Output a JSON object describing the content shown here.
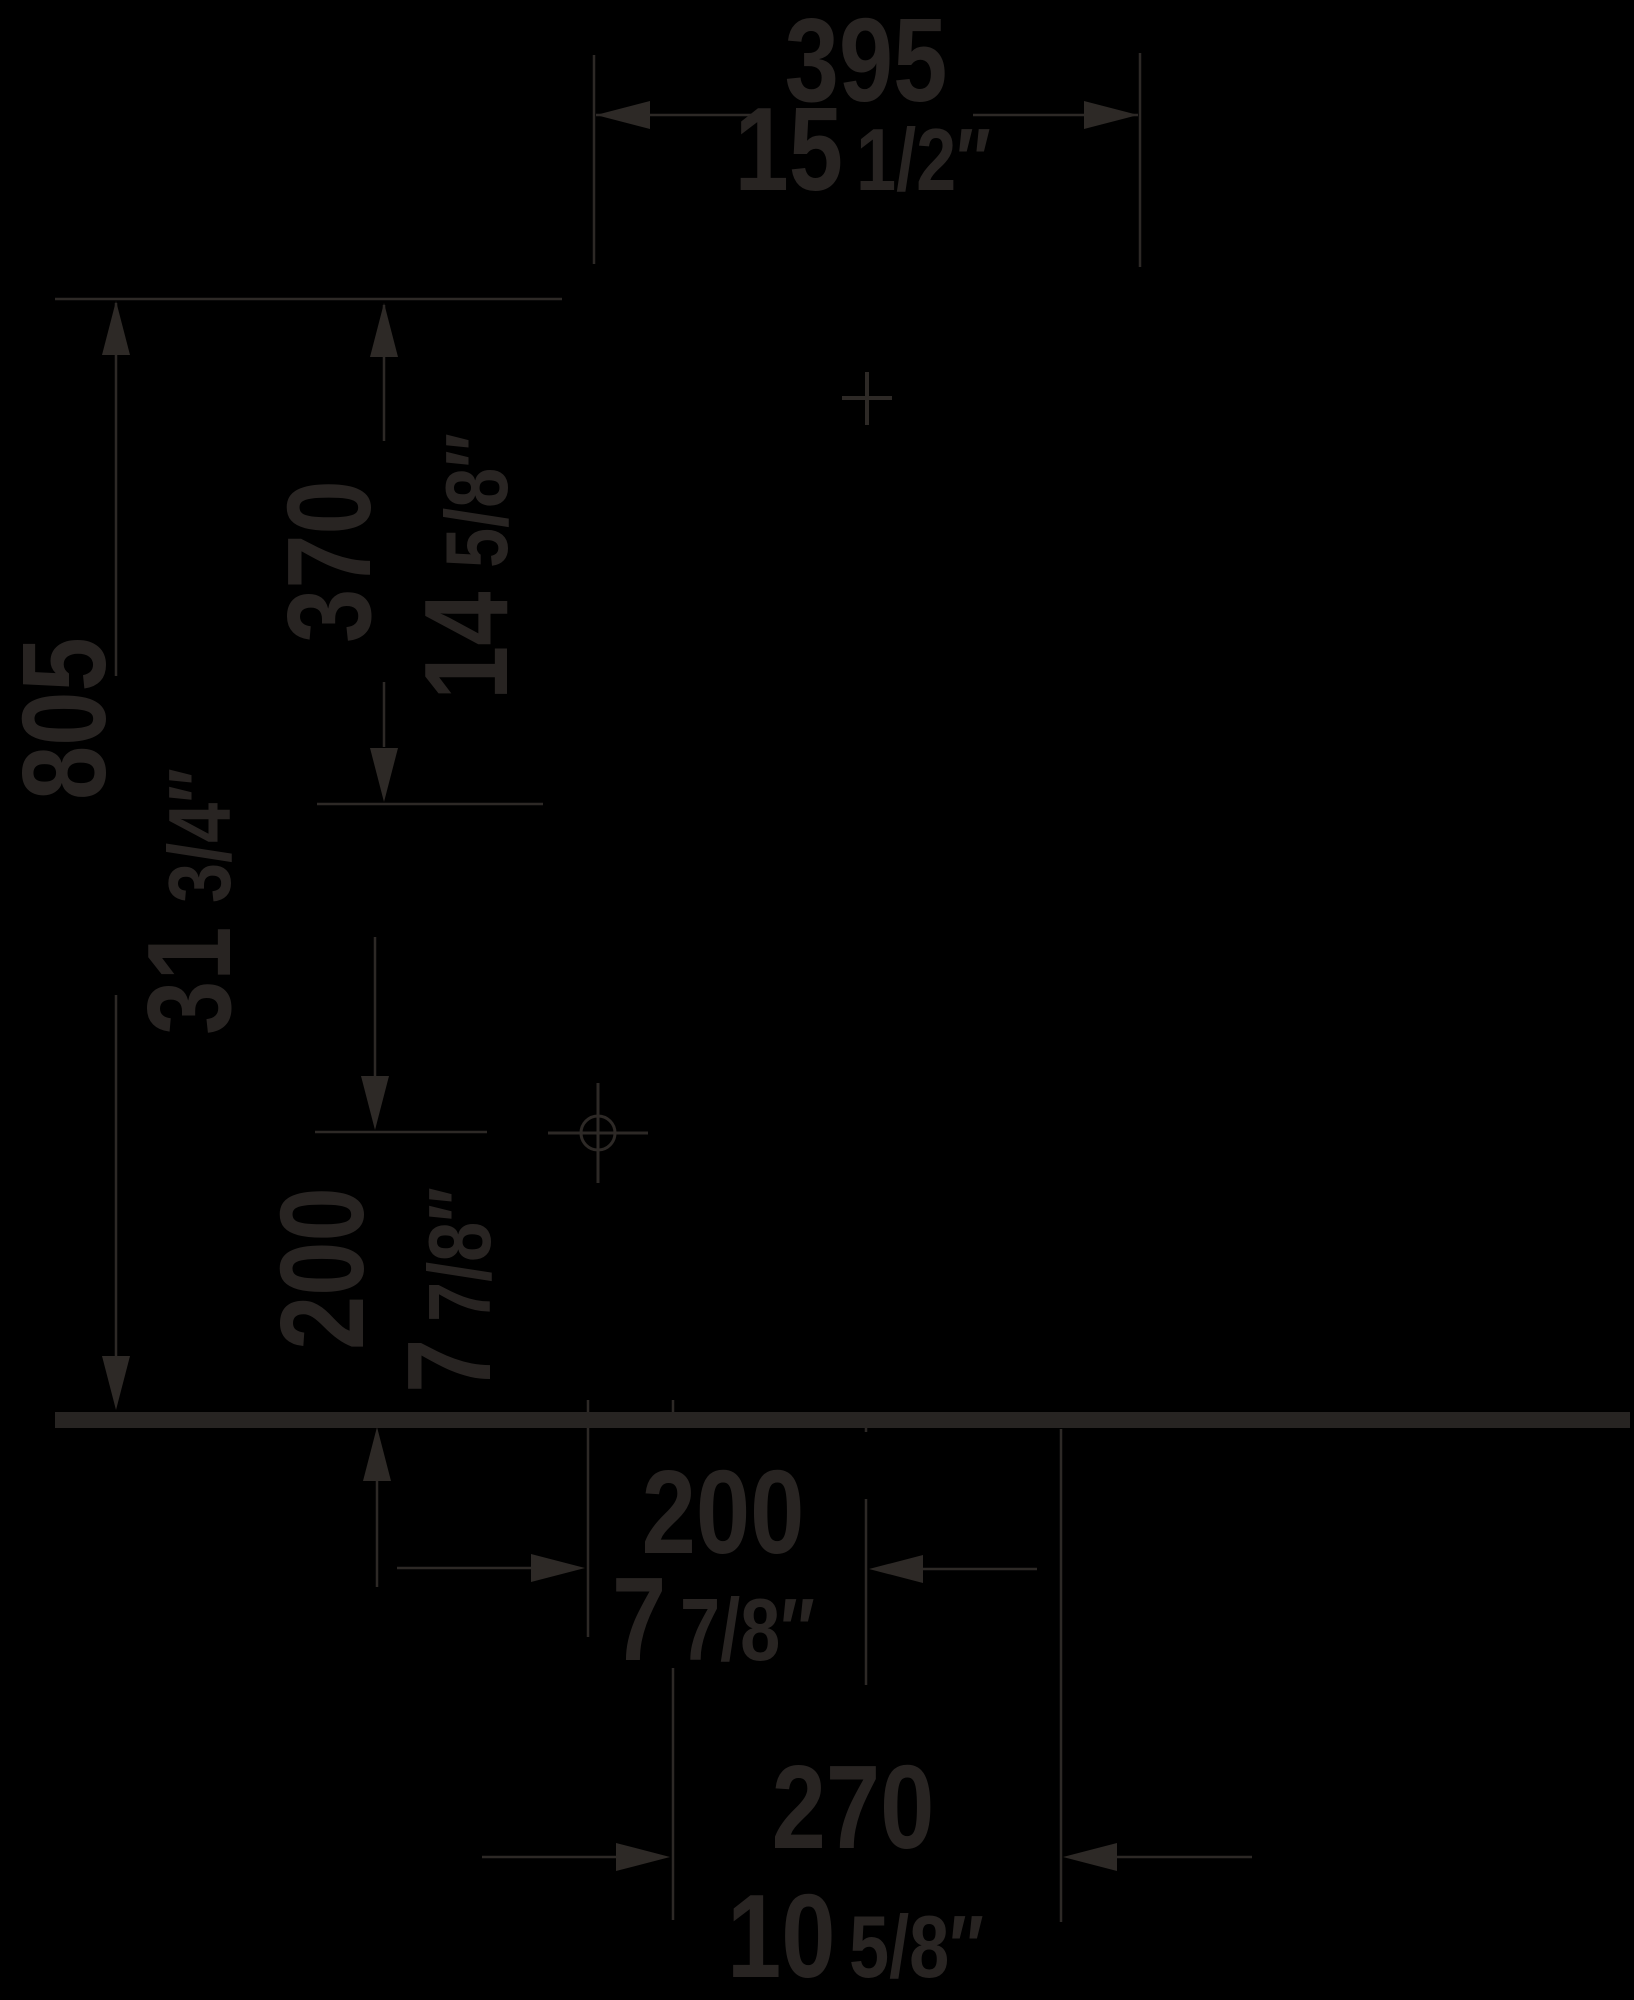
{
  "document": {
    "kind": "sanitary-installation-dimension-drawing",
    "units": "millimetres over inches",
    "background": "black, drawing inked in dark gray"
  },
  "colors": {
    "background": "#000000",
    "ink": "#2d2926",
    "text": "#282422",
    "floor": "#272422"
  },
  "dimensions": {
    "width_top": {
      "mm": "395",
      "inch_int": "15",
      "inch_frac": "1/2″",
      "orientation": "horizontal, top"
    },
    "height_total": {
      "mm": "805",
      "inch_int": "31",
      "inch_frac": "3/4″",
      "orientation": "vertical, left, rotated labels"
    },
    "height_upper": {
      "mm": "370",
      "inch_int": "14",
      "inch_frac": "5/8″",
      "orientation": "vertical, rotated labels"
    },
    "outlet_height": {
      "mm": "200",
      "inch_int": "7",
      "inch_frac": "7/8″",
      "orientation": "vertical above floor, rotated labels"
    },
    "supply_offset": {
      "mm": "200",
      "inch_int": "7",
      "inch_frac": "7/8″",
      "orientation": "horizontal below floor"
    },
    "outlet_offset": {
      "mm": "270",
      "inch_int": "10",
      "inch_frac": "5/8″",
      "orientation": "horizontal, bottom"
    }
  },
  "markers": {
    "wall_fixing_cross": "cross mark at fixture centreline",
    "supply_connection": "circle with cross axes on outlet height line",
    "floor_line": "thick horizontal floor/ground line"
  }
}
